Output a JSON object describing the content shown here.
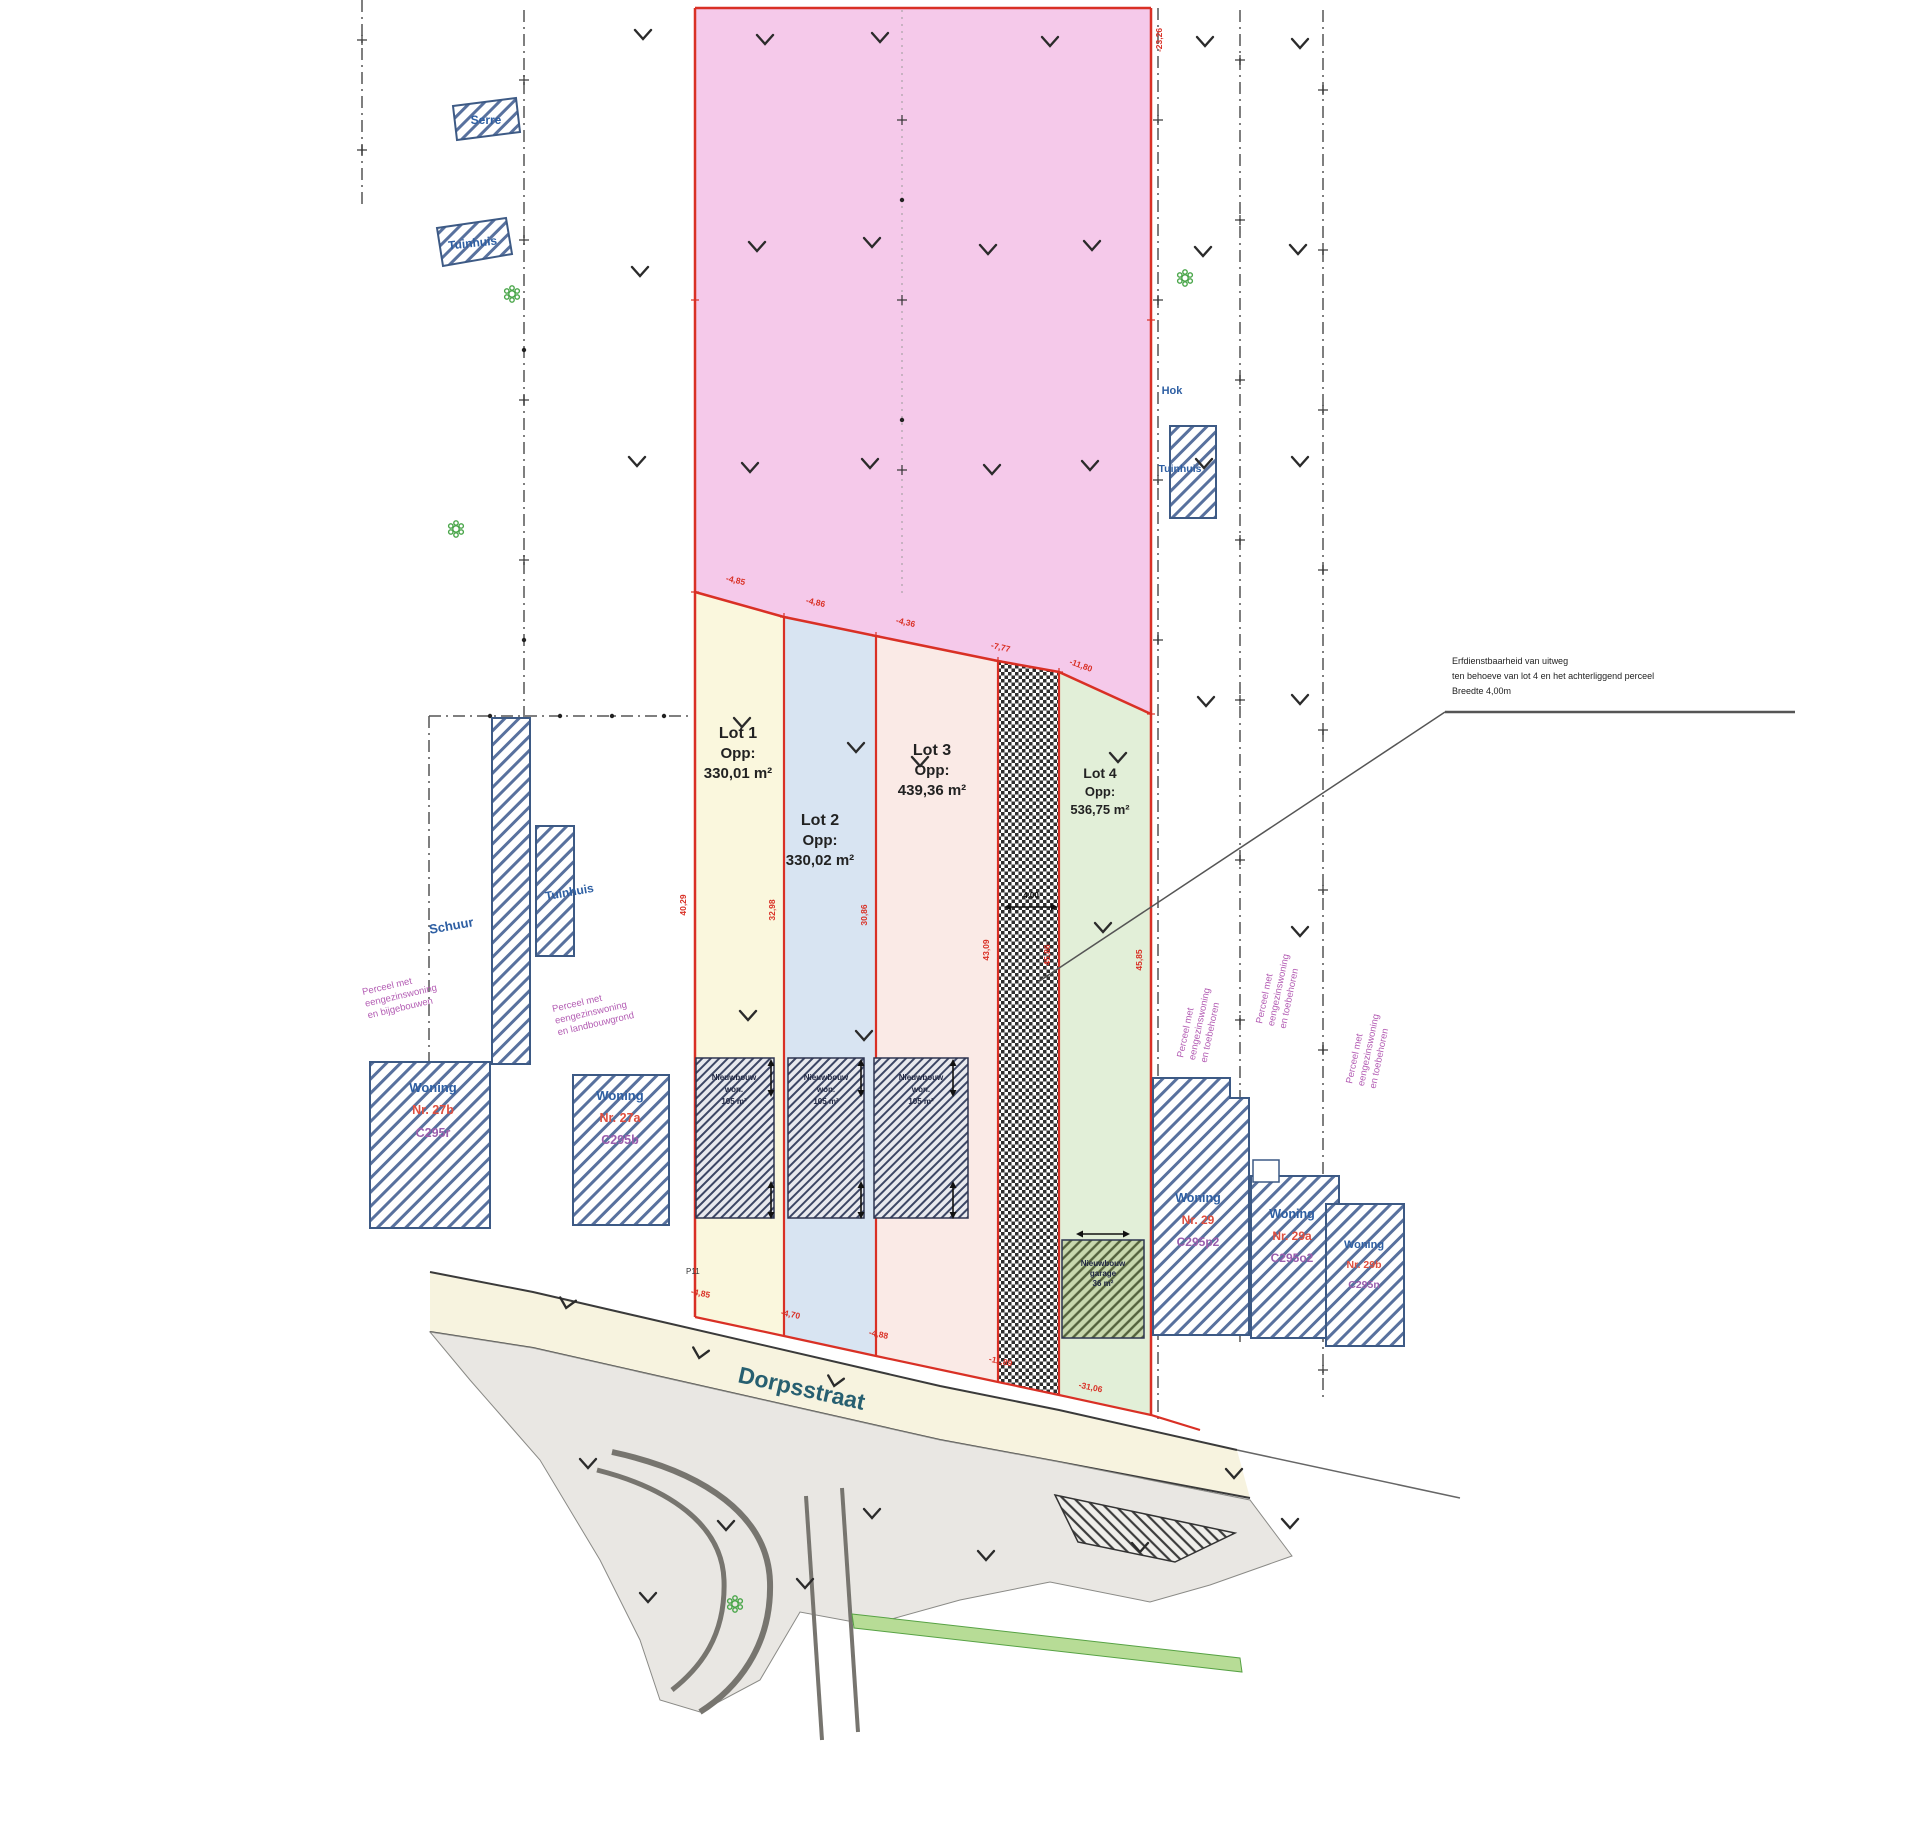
{
  "plan": {
    "lots": [
      {
        "name": "Lot 1",
        "opp": "Opp:",
        "area": "330,01 m²"
      },
      {
        "name": "Lot 2",
        "opp": "Opp:",
        "area": "330,02 m²"
      },
      {
        "name": "Lot 3",
        "opp": "Opp:",
        "area": "439,36 m²"
      },
      {
        "name": "Lot 4",
        "opp": "Opp:",
        "area": "536,75 m²"
      }
    ],
    "street": {
      "name": "Dorpsstraat"
    },
    "structures": {
      "serre": "Serre",
      "tuinhuis_left": "Tuinhuis",
      "schuur": "Schuur",
      "tuinhuis_mid": "Tuinhuis",
      "hok": "Hok",
      "tuinhuis_right": "Tuinhuis"
    },
    "houses": {
      "h27b": {
        "l1": "Woning",
        "l2": "Nr. 27b",
        "l3": "C295r"
      },
      "h27a": {
        "l1": "Woning",
        "l2": "Nr. 27a",
        "l3": "C295b"
      },
      "h29": {
        "l1": "Woning",
        "l2": "Nr. 29",
        "l3": "C295p2"
      },
      "h29a": {
        "l1": "Woning",
        "l2": "Nr. 29a",
        "l3": "C295o2"
      },
      "h29b": {
        "l1": "Woning",
        "l2": "Nr. 29b",
        "l3": "C295n"
      }
    },
    "footprint": {
      "l1": "Nieuwbouw",
      "l2": "won.",
      "l3": "105 m²"
    },
    "garage": {
      "l1": "Nieuwbouw",
      "l2": "garage",
      "l3": "36 m²"
    },
    "annotation": {
      "l1": "Erfdienstbaarheid van uitweg",
      "l2": "ten behoeve van lot 4 en het achterliggend perceel",
      "l3": "Breedte 4,00m"
    },
    "notes": {
      "left": {
        "l1": "Perceel met",
        "l2": "eengezinswoning",
        "l3": "en bijgebouwen"
      },
      "mid": {
        "l1": "Perceel met",
        "l2": "eengezinswoning",
        "l3": "en landbouwgrond"
      },
      "right1": {
        "l1": "Perceel met",
        "l2": "eengezinswoning",
        "l3": "en toebehoren"
      },
      "right2": {
        "l1": "Perceel met",
        "l2": "eengezinswoning",
        "l3": "en toebehoren"
      },
      "right3": {
        "l1": "Perceel met",
        "l2": "eengezinswoning",
        "l3": "en toebehoren"
      }
    },
    "dims": {
      "top1": "-4,85",
      "top2": "-4,86",
      "top3": "-4,36",
      "top4": "-7,77",
      "top5": "-11,80",
      "v1": "40,29",
      "v2": "32,98",
      "v3": "30,86",
      "v4": "43,09",
      "v5": "45,86",
      "v6": "45,85",
      "b1": "-4,85",
      "b2": "-4,70",
      "b3": "-4,88",
      "b4": "-11,89",
      "b5": "-31,06",
      "right_top": "-23,26",
      "strip": "4,00"
    },
    "misc": {
      "p11": "P11"
    },
    "colors": {
      "red": "#d93025",
      "blue": "#2e5fa3",
      "purple": "#b35cb3",
      "pink": "#f5c9ea",
      "lot1": "#faf7dd",
      "lot2": "#d8e4f2",
      "lot3": "#faeae6",
      "lot4": "#e2efd8",
      "street_text": "#275f70"
    }
  }
}
